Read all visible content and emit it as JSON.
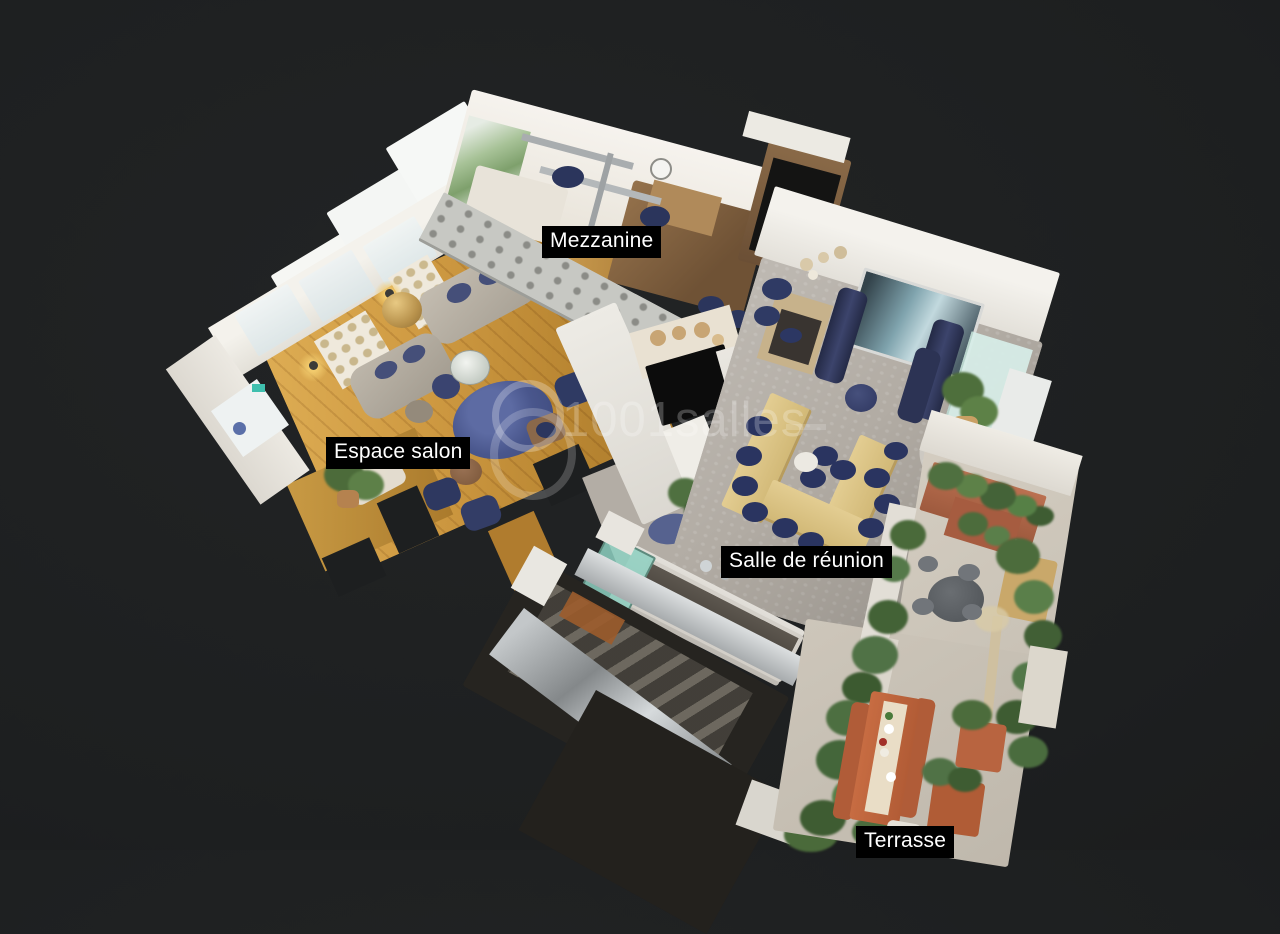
{
  "watermark": {
    "text": "1001salles",
    "logo_icon": "crescent-ring-logo",
    "color": "#ffffff",
    "opacity": 0.24
  },
  "room_labels": [
    {
      "id": "mezzanine",
      "label": "Mezzanine"
    },
    {
      "id": "espace-salon",
      "label": "Espace salon"
    },
    {
      "id": "salle-de-reunion",
      "label": "Salle de réunion"
    },
    {
      "id": "terrasse",
      "label": "Terrasse"
    }
  ],
  "label_style": {
    "background": "#000000",
    "text_color": "#ffffff"
  },
  "palette": {
    "background": "#1d1f20",
    "wood_floor": "#c9913f",
    "concrete_floor": "#b2aca4",
    "stone_terrace": "#cdc6ba",
    "white_walls": "#efece6",
    "navy_furniture": "#2f3a63",
    "blue_rug": "#49568c",
    "terracotta": "#b05c38",
    "plants_green": "#4c6c3c",
    "metal_silver": "#a7abad"
  }
}
